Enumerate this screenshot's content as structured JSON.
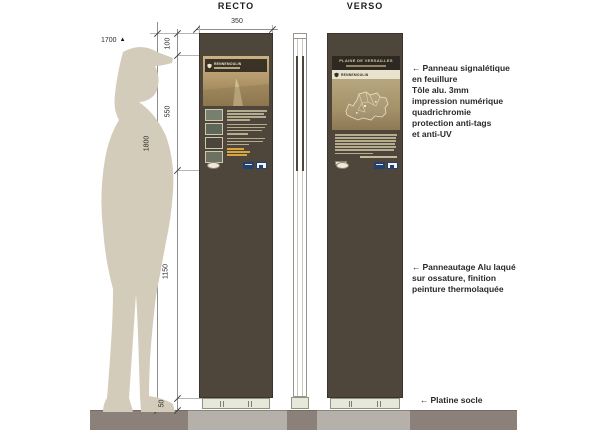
{
  "titles": {
    "recto": "RECTO",
    "verso": "VERSO"
  },
  "dimensions": {
    "width": "350",
    "segments": [
      "100",
      "550",
      "1150",
      "50"
    ],
    "total": "1800",
    "level": "1700",
    "level_marker": "▲"
  },
  "annotations": {
    "panel": {
      "arrow": "←",
      "lines": [
        "Panneau signalétique",
        "en feuillure",
        "Tôle alu. 3mm",
        "impression numérique",
        "quadrichromie",
        "protection anti-tags",
        "et anti-UV"
      ]
    },
    "body": {
      "arrow": "←",
      "lines": [
        "Panneautage Alu laqué",
        "sur ossature, finition",
        "peinture thermolaquée"
      ]
    },
    "base": {
      "arrow": "←",
      "label": "Platine socle"
    }
  },
  "recto_sign": {
    "title": "RENNEMOULIN"
  },
  "verso_sign": {
    "title": "PLAINE DE VERSAILLES",
    "band": "RENNEMOULIN"
  },
  "colors": {
    "panel_brown": "#4e453b",
    "person_beige": "#d4ccba",
    "ground_light": "#b6b0ab",
    "ground_dark": "#8b817a",
    "platine": "#e6e8d9",
    "accent_orange": "#d8a43c",
    "logo_blue": "#24406e"
  }
}
